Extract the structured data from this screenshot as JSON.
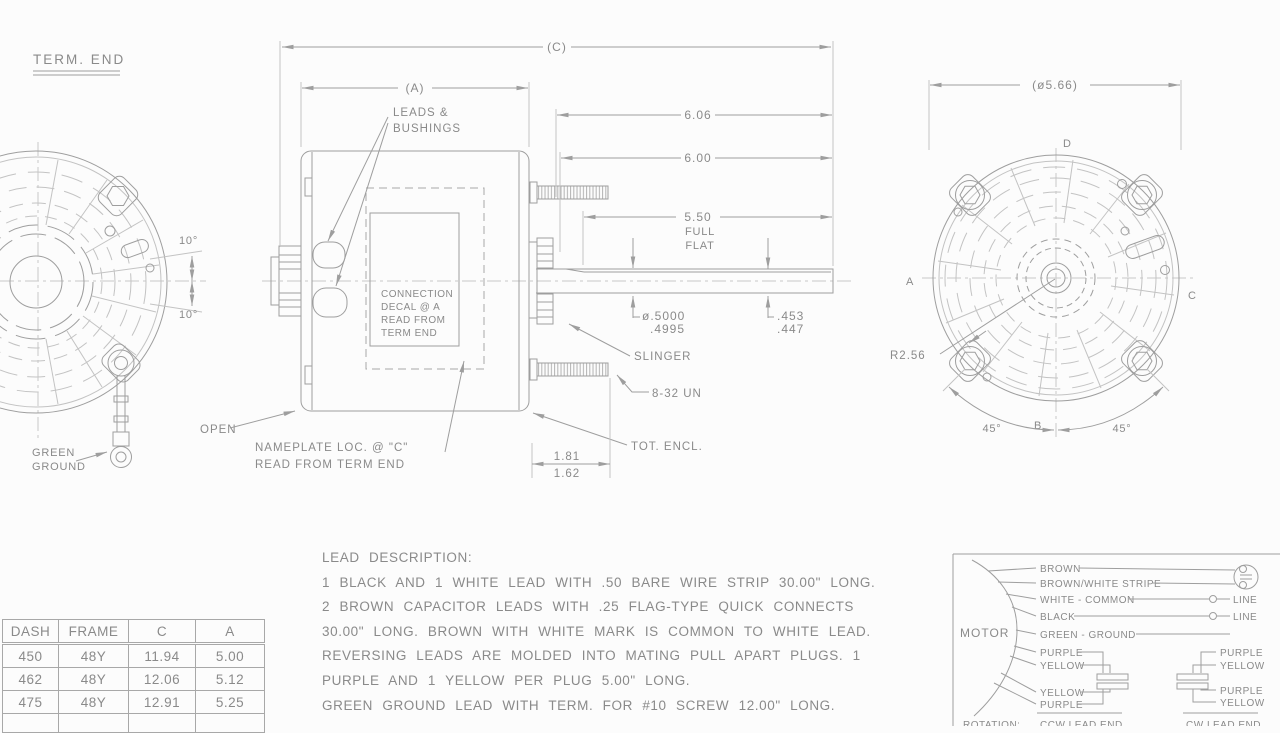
{
  "colors": {
    "background": "#fcfcfc",
    "line": "#9e9e9e",
    "text": "#8a8a8a",
    "light_line": "#c3c3c3"
  },
  "term_end_view": {
    "title": "TERM. END",
    "angle_top": "10°",
    "angle_bottom": "10°",
    "ground_label_line1": "GREEN",
    "ground_label_line2": "GROUND"
  },
  "side_view": {
    "dim_c": "(C)",
    "dim_a": "(A)",
    "leads_label_line1": "LEADS &",
    "leads_label_line2": "BUSHINGS",
    "decal_line1": "CONNECTION",
    "decal_line2": "DECAL @ A",
    "decal_line3": "READ FROM",
    "decal_line4": "TERM END",
    "open_label": "OPEN",
    "nameplate_line1": "NAMEPLATE LOC. @ \"C\"",
    "nameplate_line2": "READ FROM TERM END",
    "dim_606": "6.06",
    "dim_600": "6.00",
    "dim_550": "5.50",
    "full_label": "FULL",
    "flat_label": "FLAT",
    "shaft_dia_top": "ø.5000",
    "shaft_dia_bot": ".4995",
    "flat_dim_top": ".453",
    "flat_dim_bot": ".447",
    "slinger_label": "SLINGER",
    "stud_label": "8-32 UN",
    "tot_encl_label": "TOT. ENCL.",
    "hub_dim_top": "1.81",
    "hub_dim_bot": "1.62"
  },
  "shaft_end_view": {
    "dia_label": "(ø5.66)",
    "point_a": "A",
    "point_b": "B",
    "point_c": "C",
    "point_d": "D",
    "radius_label": "R2.56",
    "angle_left": "45°",
    "angle_right": "45°"
  },
  "dimension_table": {
    "headers": [
      "DASH",
      "FRAME",
      "C",
      "A"
    ],
    "rows": [
      [
        "450",
        "48Y",
        "11.94",
        "5.00"
      ],
      [
        "462",
        "48Y",
        "12.06",
        "5.12"
      ],
      [
        "475",
        "48Y",
        "12.91",
        "5.25"
      ],
      [
        "",
        "",
        "",
        ""
      ]
    ]
  },
  "lead_description": {
    "title": "LEAD DESCRIPTION:",
    "lines": [
      "1 BLACK AND 1 WHITE LEAD WITH .50 BARE WIRE STRIP 30.00\" LONG.",
      "2 BROWN CAPACITOR LEADS WITH .25 FLAG-TYPE QUICK CONNECTS",
      "30.00\" LONG. BROWN WITH WHITE MARK IS COMMON TO WHITE LEAD.",
      "REVERSING LEADS ARE MOLDED INTO MATING PULL APART PLUGS. 1",
      "PURPLE AND 1 YELLOW PER PLUG 5.00\" LONG.",
      "GREEN GROUND LEAD WITH TERM. FOR #10 SCREW 12.00\" LONG."
    ]
  },
  "wiring_diagram": {
    "motor_label": "MOTOR",
    "leads": [
      "BROWN",
      "BROWN/WHITE STRIPE",
      "WHITE - COMMON",
      "BLACK",
      "GREEN - GROUND",
      "PURPLE",
      "YELLOW",
      "YELLOW",
      "PURPLE"
    ],
    "right_leads": [
      "PURPLE",
      "YELLOW",
      "PURPLE",
      "YELLOW"
    ],
    "line_label_1": "LINE",
    "line_label_2": "LINE",
    "rotation_label": "ROTATION:",
    "ccw_label": "CCW LEAD END",
    "cw_label": "CW LEAD END"
  }
}
